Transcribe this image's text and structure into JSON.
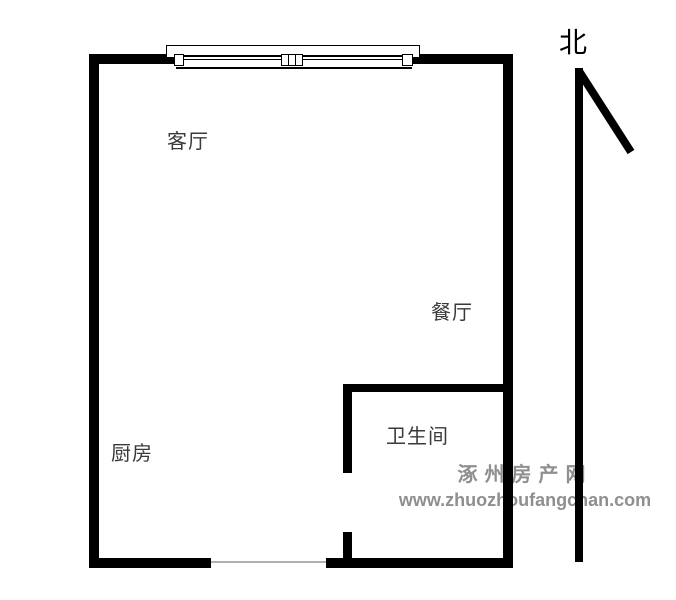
{
  "floorplan": {
    "rooms": [
      {
        "name": "living-room",
        "label": "客厅"
      },
      {
        "name": "dining-room",
        "label": "餐厅"
      },
      {
        "name": "kitchen",
        "label": "厨房"
      },
      {
        "name": "bathroom",
        "label": "卫生间"
      }
    ],
    "compass": {
      "label": "北"
    },
    "colors": {
      "wall": "#000000",
      "room_label": "#3a3a3a",
      "watermark": "#8f8f8f",
      "threshold": "#b0b0b0",
      "background": "#ffffff"
    }
  },
  "watermark": {
    "site_name": "涿州房产网",
    "site_url": "www.zhuozhoufangchan.com"
  }
}
